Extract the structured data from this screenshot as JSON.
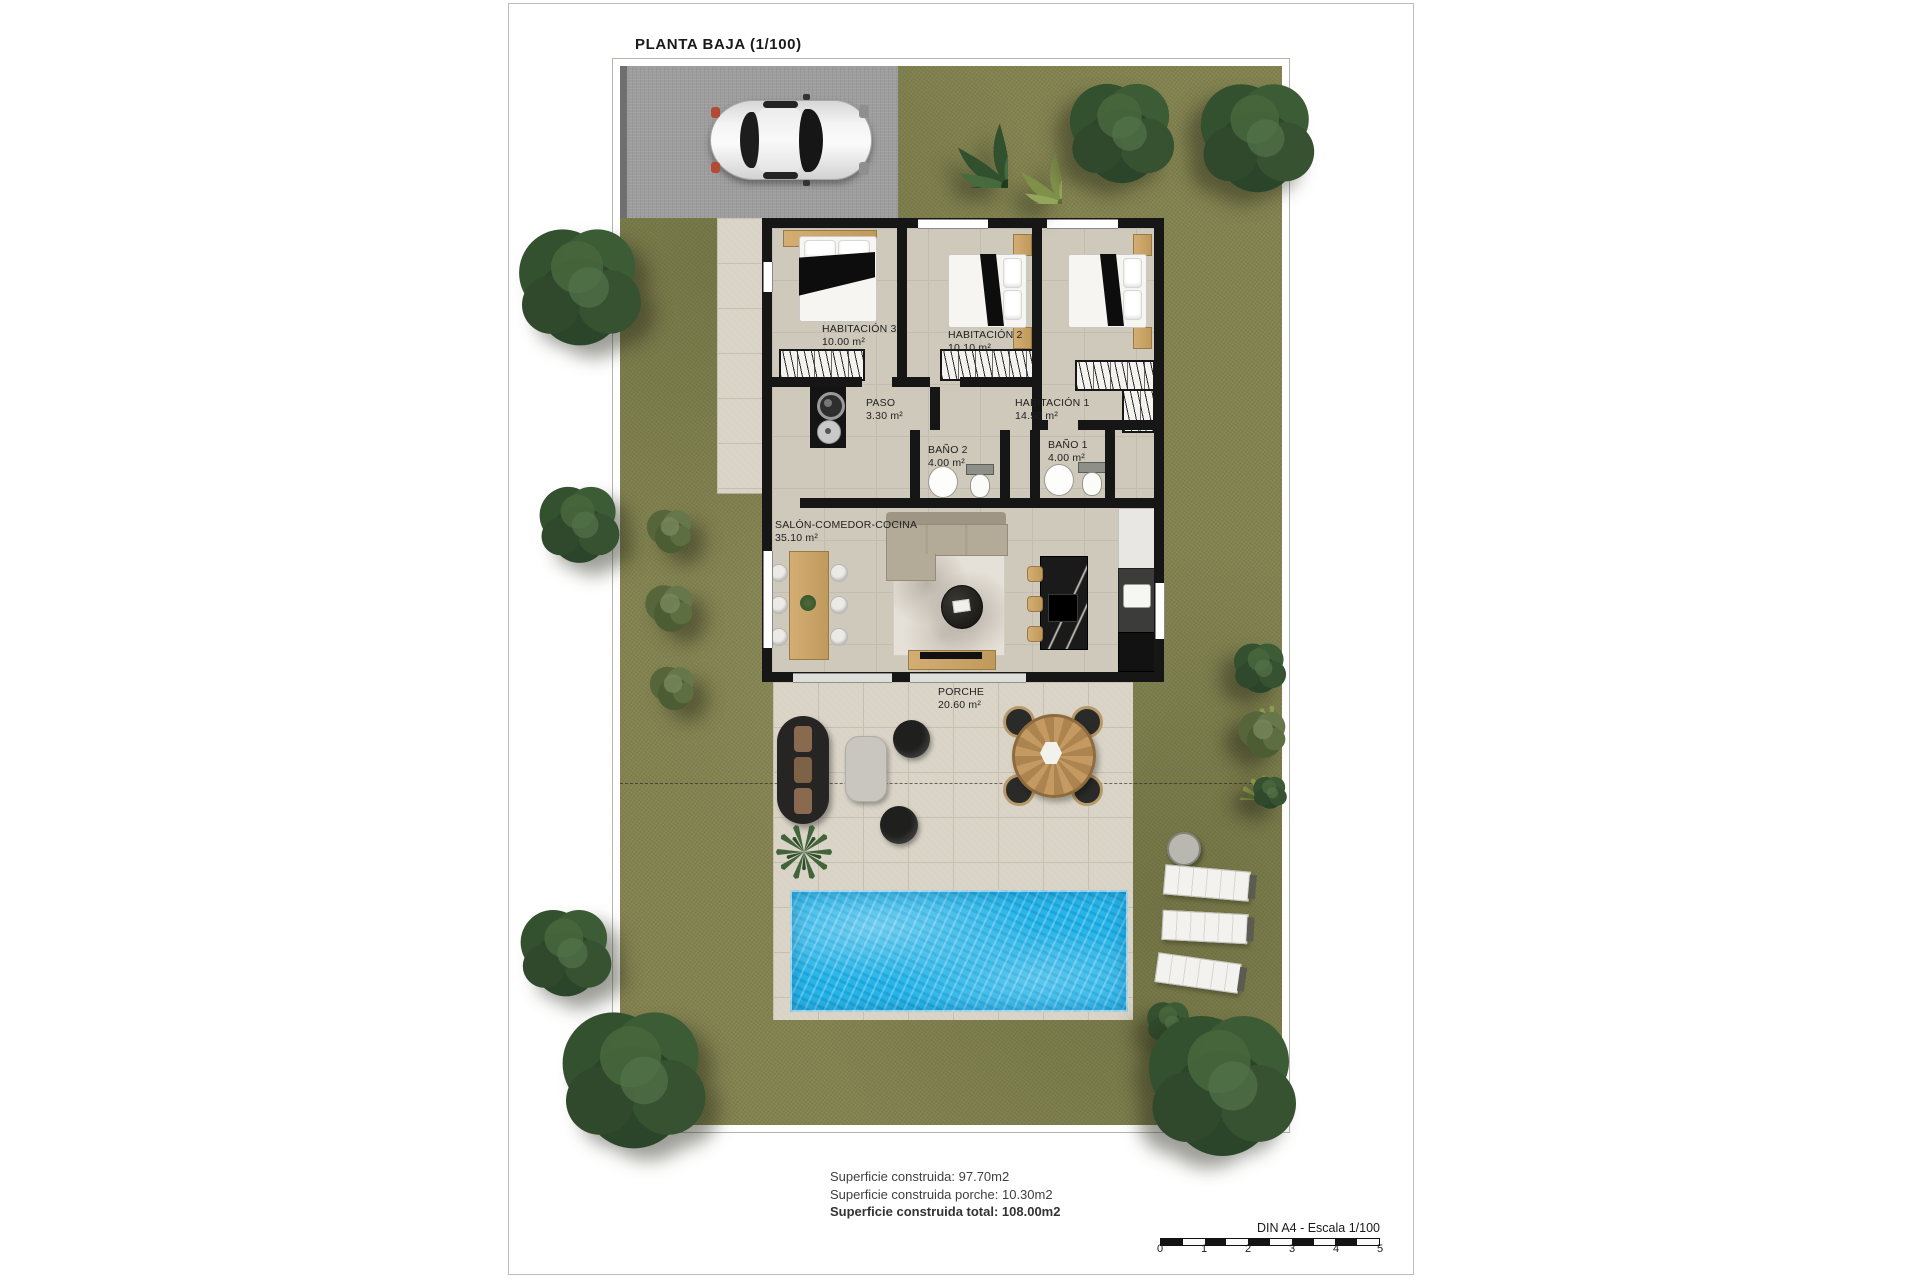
{
  "title": "PLANTA BAJA (1/100)",
  "rooms": {
    "hab3": {
      "name": "HABITACIÓN 3",
      "area": "10.00 m²"
    },
    "hab2": {
      "name": "HABITACIÓN 2",
      "area": "10.10 m²"
    },
    "hab1": {
      "name": "HABITACIÓN 1",
      "area": "14.50 m²"
    },
    "paso": {
      "name": "PASO",
      "area": "3.30 m²"
    },
    "bano2": {
      "name": "BAÑO 2",
      "area": "4.00 m²"
    },
    "bano1": {
      "name": "BAÑO 1",
      "area": "4.00 m²"
    },
    "salon": {
      "name": "SALÓN-COMEDOR-COCINA",
      "area": "35.10 m²"
    },
    "porche": {
      "name": "PORCHE",
      "area": "20.60 m²"
    }
  },
  "summary": {
    "construida": "Superficie construida: 97.70m2",
    "porche": "Superficie construida porche: 10.30m2",
    "total": "Superficie construida total: 108.00m2"
  },
  "scalebar": {
    "label": "DIN A4 - Escala 1/100",
    "ticks": [
      "0",
      "1",
      "2",
      "3",
      "4",
      "5"
    ]
  },
  "colors": {
    "grass": "#82824f",
    "pool": "#27b5e9",
    "wall": "#161616",
    "floor": "#cfc9bb",
    "paving": "#d9d3c6",
    "driveway": "#9d9d9d"
  }
}
